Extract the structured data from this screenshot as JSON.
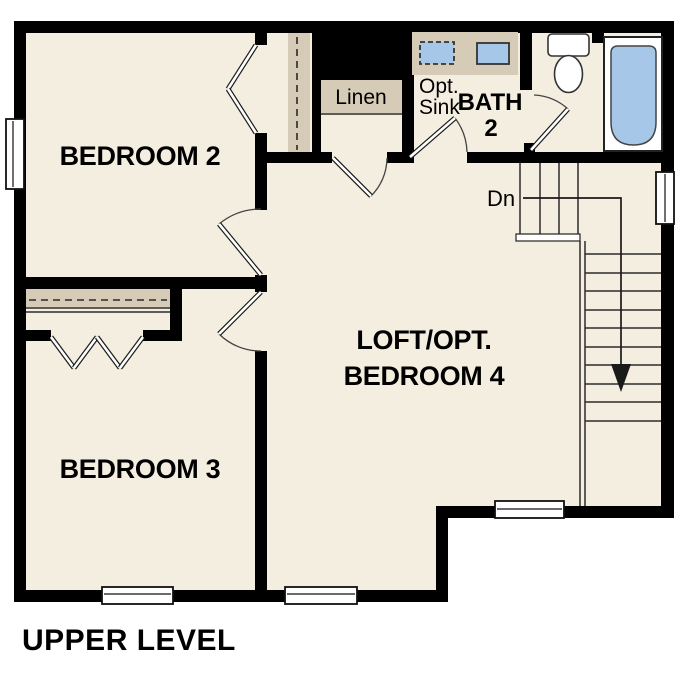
{
  "plan_title": "UPPER LEVEL",
  "colors": {
    "floor": "#f4eee1",
    "casework": "#d5cbb6",
    "fixture_blue": "#a6c7e8",
    "wall": "#000000"
  },
  "rooms": {
    "bedroom2": {
      "label": "BEDROOM 2"
    },
    "bedroom3": {
      "label": "BEDROOM 3"
    },
    "loft": {
      "label_line1": "LOFT/OPT.",
      "label_line2": "BEDROOM 4"
    },
    "bath2": {
      "label_line1": "BATH",
      "label_line2": "2"
    },
    "opt_sink": {
      "line1": "Opt.",
      "line2": "Sink"
    },
    "linen": {
      "label": "Linen"
    }
  },
  "stairs": {
    "down_label": "Dn"
  }
}
